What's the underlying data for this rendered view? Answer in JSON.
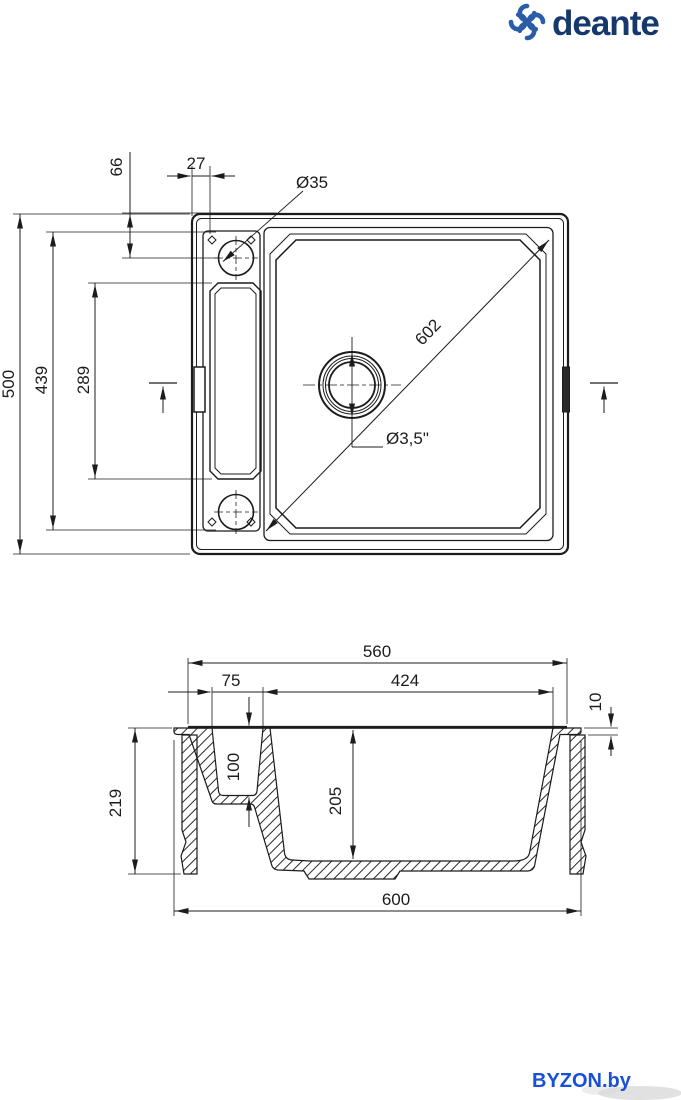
{
  "brand": {
    "logo_text": "deante",
    "logo_text_color": "#16386c",
    "logo_icon_color": "#2a5ca8",
    "logo_icon": "pinwheel-icon"
  },
  "watermark": {
    "text": "BYZON.by",
    "color": "#1950d8"
  },
  "top_view": {
    "title": "sink plan view",
    "dims": {
      "tap_hole_offset_y": "66",
      "tap_hole_offset_x": "27",
      "tap_hole_diameter": "Ø35",
      "bowl_diagonal": "602",
      "drain_diameter": "Ø3,5\"",
      "overall_depth": "500",
      "inner_length": "439",
      "recess_length": "289"
    }
  },
  "section_view": {
    "title": "sink cross-section",
    "dims": {
      "top_width": "560",
      "recess_width": "75",
      "bowl_width": "424",
      "rim_height": "10",
      "recess_depth": "100",
      "bowl_depth": "205",
      "overall_height": "219",
      "overall_width": "600"
    }
  }
}
